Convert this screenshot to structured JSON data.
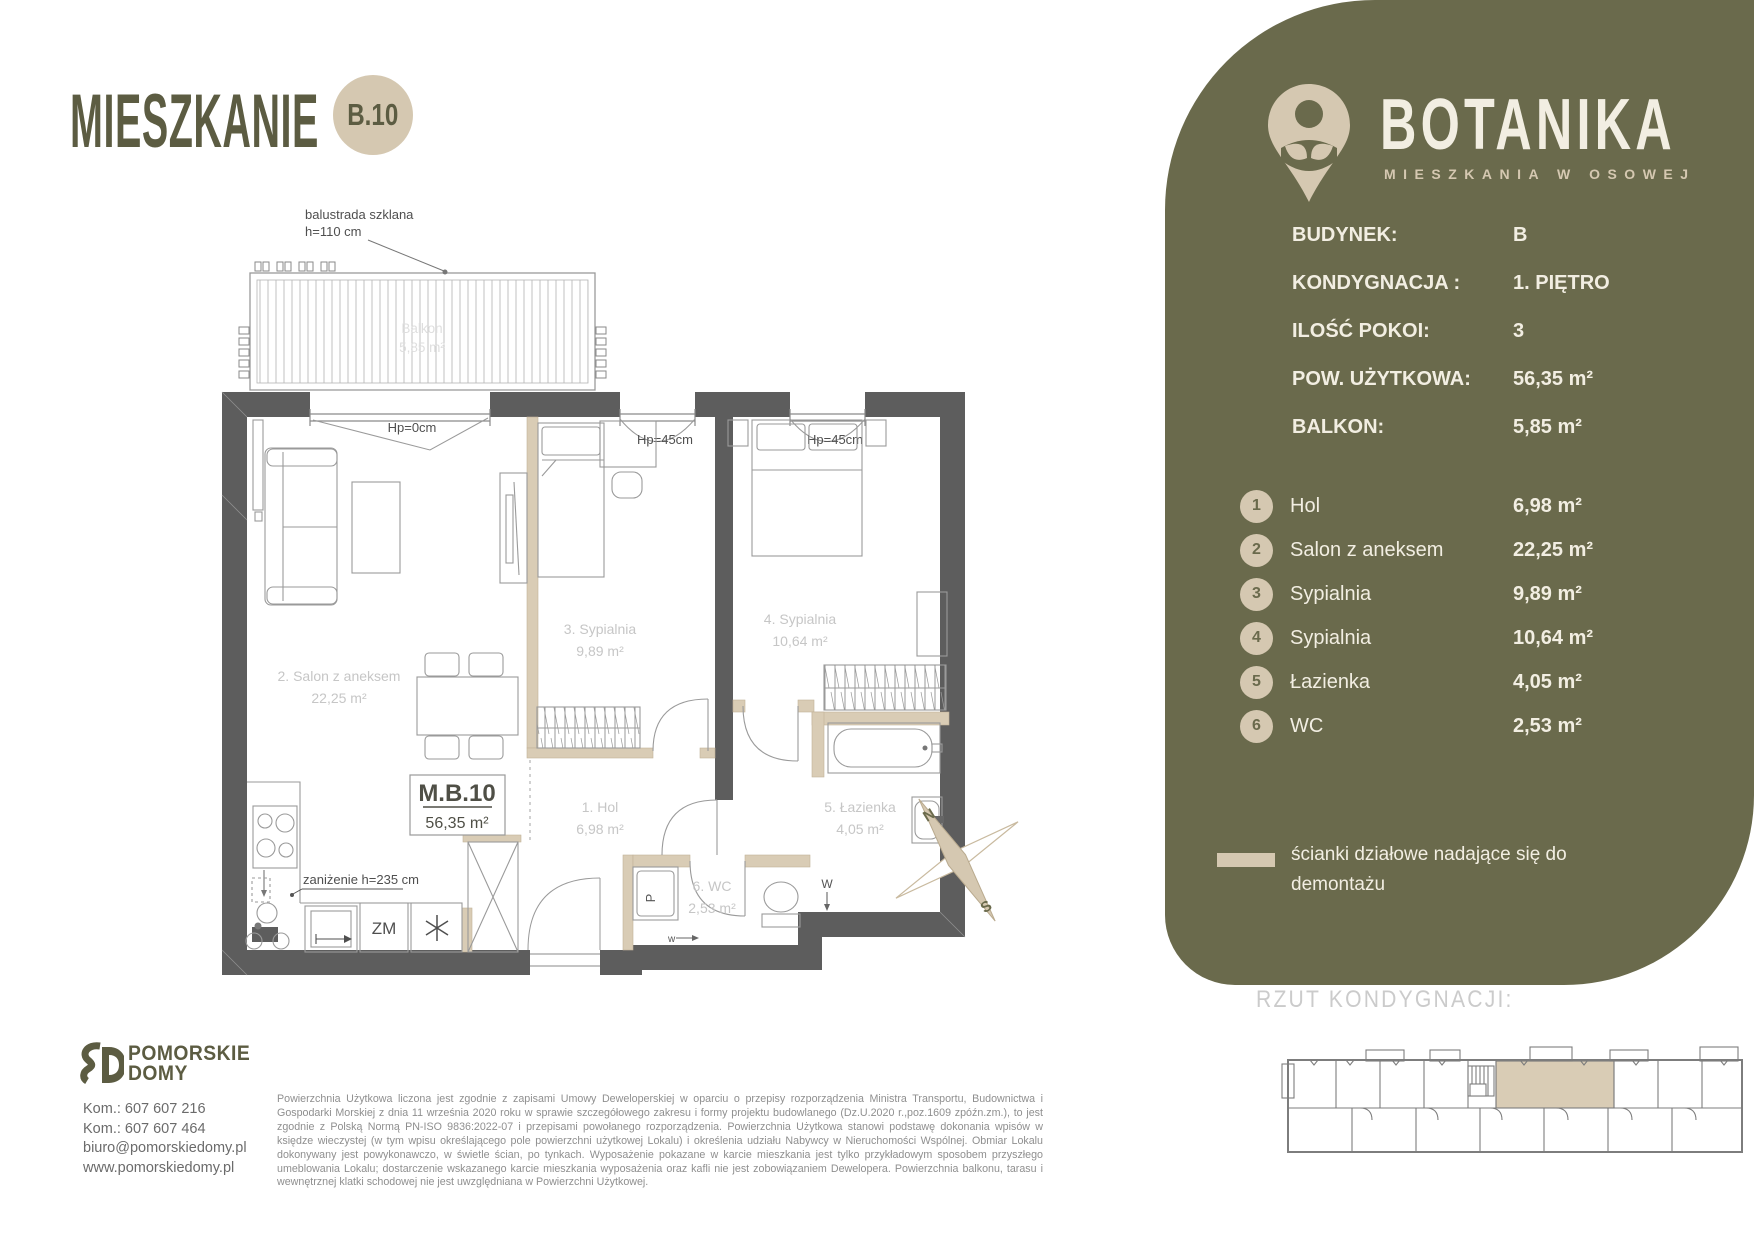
{
  "page": {
    "title": "MIESZKANIE",
    "unit_badge": "B.10"
  },
  "brand": {
    "name": "BOTANIKA",
    "tagline": "MIESZKANIA W OSOWEJ"
  },
  "summary": {
    "rows": [
      {
        "label": "BUDYNEK:",
        "value": "B"
      },
      {
        "label": "KONDYGNACJA :",
        "value": "1. PIĘTRO"
      },
      {
        "label": "ILOŚĆ POKOI:",
        "value": "3"
      },
      {
        "label": "POW. UŻYTKOWA:",
        "value": "56,35 m²"
      },
      {
        "label": "BALKON:",
        "value": "5,85 m²"
      }
    ]
  },
  "rooms": [
    {
      "no": "1",
      "name": "Hol",
      "area": "6,98 m²"
    },
    {
      "no": "2",
      "name": "Salon z aneksem",
      "area": "22,25 m²"
    },
    {
      "no": "3",
      "name": "Sypialnia",
      "area": "9,89 m²"
    },
    {
      "no": "4",
      "name": "Sypialnia",
      "area": "10,64 m²"
    },
    {
      "no": "5",
      "name": "Łazienka",
      "area": "4,05 m²"
    },
    {
      "no": "6",
      "name": "WC",
      "area": "2,53 m²"
    }
  ],
  "legend": {
    "text": "ścianki działowe nadające się do demontażu"
  },
  "floor_overview": {
    "heading": "RZUT KONDYGNACJI:"
  },
  "plan": {
    "balustrade_line1": "balustrada szklana",
    "balustrade_line2": "h=110 cm",
    "balcony_name": "Balkon",
    "balcony_area": "5,85 m²",
    "door_sill_0": "Hp=0cm",
    "window_sill_1": "Hp=45cm",
    "window_sill_2": "Hp=45cm",
    "room1_name": "1. Hol",
    "room1_area": "6,98 m²",
    "room2_name": "2. Salon z aneksem",
    "room2_area": "22,25 m²",
    "room3_name": "3. Sypialnia",
    "room3_area": "9,89 m²",
    "room4_name": "4. Sypialnia",
    "room4_area": "10,64 m²",
    "room5_name": "5. Łazienka",
    "room5_area": "4,05 m²",
    "room6_name": "6. WC",
    "room6_area": "2,53 m²",
    "unit_code": "M.B.10",
    "unit_area": "56,35 m²",
    "lowered_ceiling": "zaniżenie h=235 cm",
    "dishwasher": "ZM",
    "washing_machine": "P",
    "vent_w": "W",
    "vent_w2": "w",
    "compass_north": "N",
    "compass_south": "S"
  },
  "developer": {
    "name_line1": "POMORSKIE",
    "name_line2": "DOMY",
    "contact_lines": [
      "Kom.: 607 607 216",
      "Kom.: 607 607 464",
      "biuro@pomorskiedomy.pl",
      "www.pomorskiedomy.pl"
    ]
  },
  "disclaimer": "Powierzchnia Użytkowa liczona jest zgodnie z zapisami Umowy Deweloperskiej w oparciu o przepisy rozporządzenia Ministra Transportu, Budownictwa i Gospodarki Morskiej z dnia 11 września 2020 roku w sprawie szczegółowego zakresu i formy projektu budowlanego (Dz.U.2020 r.,poz.1609 zpóźn.zm.), to jest zgodnie z Polską Normą PN-ISO 9836:2022-07 i przepisami powołanego rozporządzenia. Powierzchnia Użytkowa stanowi podstawę dokonania wpisów w księdze wieczystej (w tym wpisu określającego pole powierzchni użytkowej Lokalu) i określenia udziału Nabywcy w Nieruchomości Wspólnej. Obmiar Lokalu dokonywany jest powykonawczo, w świetle ścian, po tynkach. Wyposażenie pokazane w karcie mieszkania jest tylko przykładowym sposobem przyszłego umeblowania Lokalu; dostarczenie wskazanego karcie mieszkania wyposażenia oraz kafli nie jest zobowiązaniem Dewelopera. Powierzchnia balkonu, tarasu i wewnętrznej klatki schodowej nie jest uwzględniana w Powierzchni Użytkowej.",
  "colors": {
    "olive": "#6a6a4c",
    "beige": "#d5c8b1",
    "cream": "#f2eee2",
    "wall_gray": "#5d5d5d",
    "faint_label": "#c6c6c6"
  }
}
